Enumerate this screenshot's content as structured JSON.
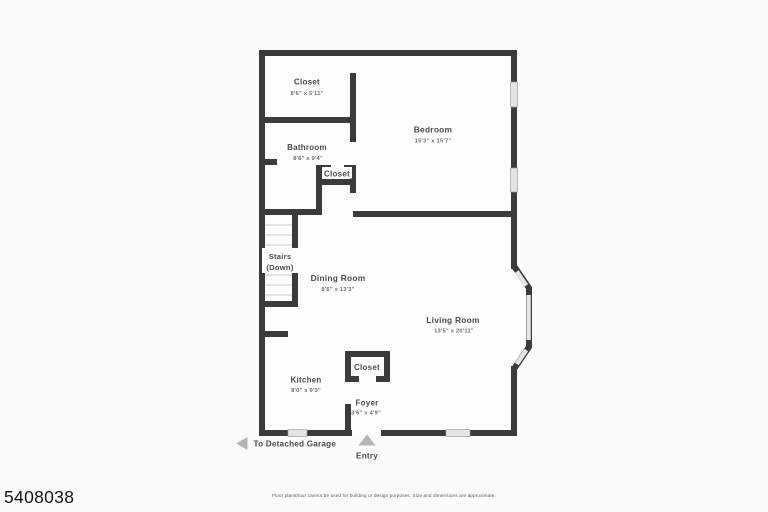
{
  "page": {
    "watermark": "5408038",
    "disclaimer": "Floor plans/tour cannot be used for building or design purposes. Size and dimensions are approximate."
  },
  "floorplan": {
    "colors": {
      "wall": "#3b3b3b",
      "window": "#e5e5e5",
      "arrow": "#b5b5b5",
      "interior": "#fdfdfd"
    },
    "rooms": {
      "closet_upper": {
        "name": "Closet",
        "dims": "8'6\" x 5'11\""
      },
      "bedroom": {
        "name": "Bedroom",
        "dims": "15'3\" x 15'7\""
      },
      "bathroom": {
        "name": "Bathroom",
        "dims": "8'6\" x 9'4\""
      },
      "closet_hall": {
        "name": "Closet"
      },
      "stairs": {
        "line1": "Stairs",
        "line2": "(Down)"
      },
      "dining_room": {
        "name": "Dining Room",
        "dims": "8'6\" x 13'3\""
      },
      "living_room": {
        "name": "Living Room",
        "dims": "13'5\" x 20'11\""
      },
      "closet_foyer": {
        "name": "Closet"
      },
      "kitchen": {
        "name": "Kitchen",
        "dims": "8'0\" x 9'3\""
      },
      "foyer": {
        "name": "Foyer",
        "dims": "3'6\" x 4'9\""
      }
    },
    "annotations": {
      "garage": {
        "label": "To Detached Garage"
      },
      "entry": {
        "label": "Entry"
      }
    }
  }
}
